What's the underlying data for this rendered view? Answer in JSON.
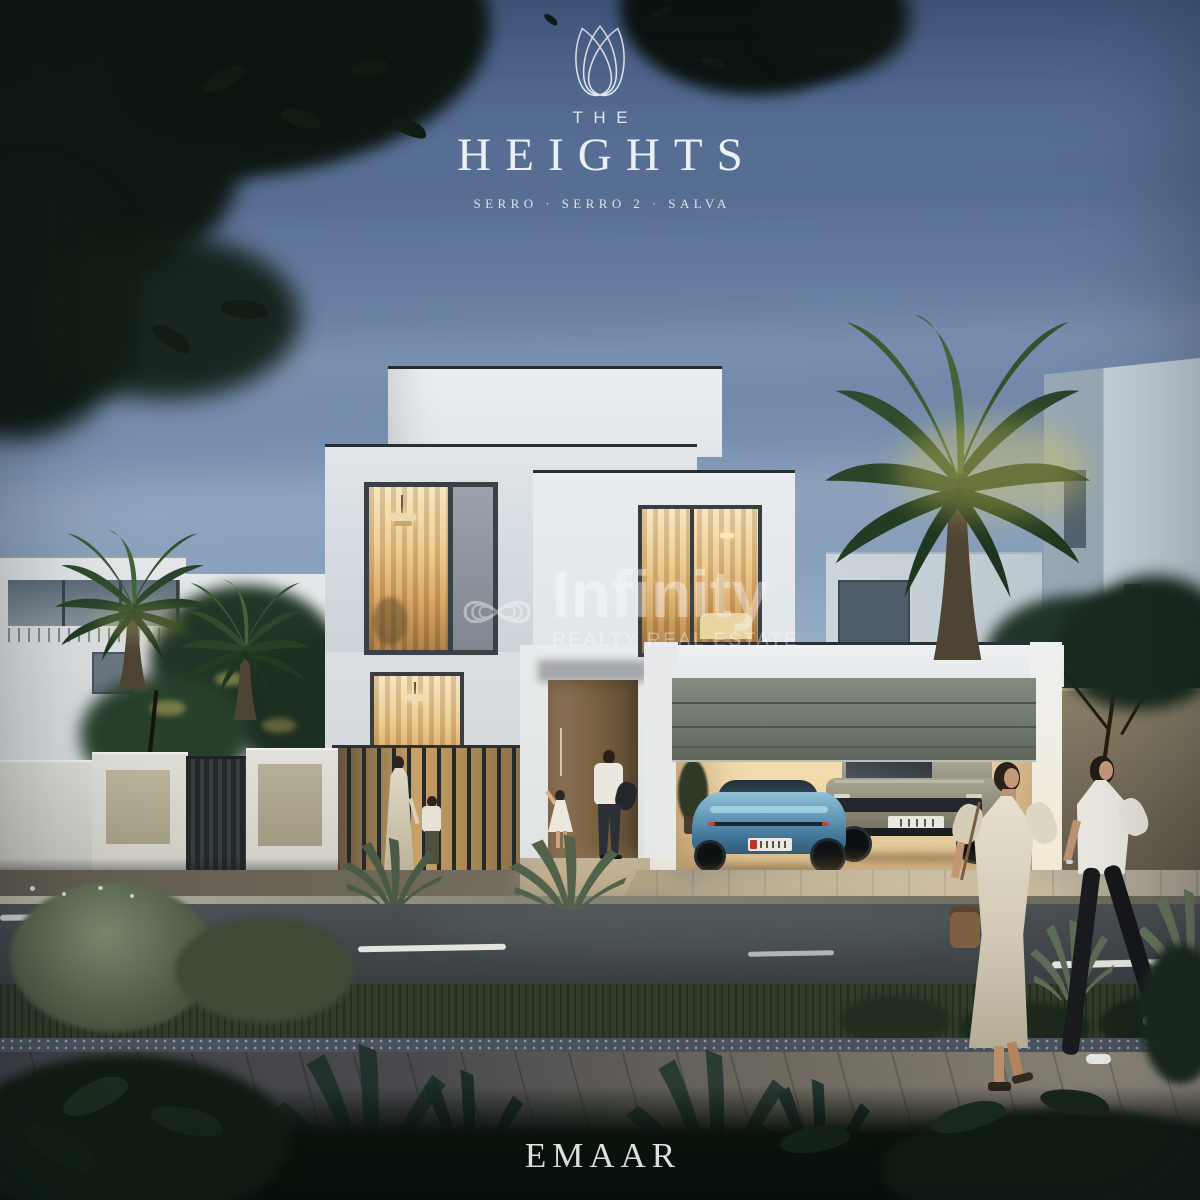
{
  "brand": {
    "logo_icon": "heights-arch-monogram-icon",
    "prefix": "THE",
    "name": "HEIGHTS",
    "communities": "SERRO · SERRO 2 · SALVA"
  },
  "watermark": {
    "logo_icon": "infinity-loops-icon",
    "name": "Infinity",
    "tagline": "REALTY REAL ESTATE"
  },
  "footer": {
    "developer": "EMAAR"
  },
  "palette": {
    "sky_top": "#4a6085",
    "sky_mid": "#93aac4",
    "sky_horizon": "#dde3e8",
    "foliage_silhouette": "#0c150f",
    "villa_white": "#e9edf0",
    "window_glow_light": "#f6e3bd",
    "window_glow_deep": "#c08b4a",
    "garage_door_grey": "#757d73",
    "entry_door_bronze": "#7e6347",
    "car_teal_blue": "#5a92b3",
    "car_suv_sand": "#938f7e",
    "road_asphalt": "#3e4448",
    "marking_white": "#e6e6e1",
    "text_white": "#f1f3f4",
    "watermark_white": "rgba(255,255,255,0.40)"
  },
  "scene": {
    "description": "Dusk render of a modern two-storey villa with warm lit interiors, open garage with two cars, palm trees, a family at the entrance and two women walking past a road",
    "objects": [
      "villa",
      "garage",
      "sports-car",
      "suv",
      "palm-trees",
      "family",
      "pedestrians",
      "road",
      "agave-plants",
      "emaar-branding"
    ]
  }
}
